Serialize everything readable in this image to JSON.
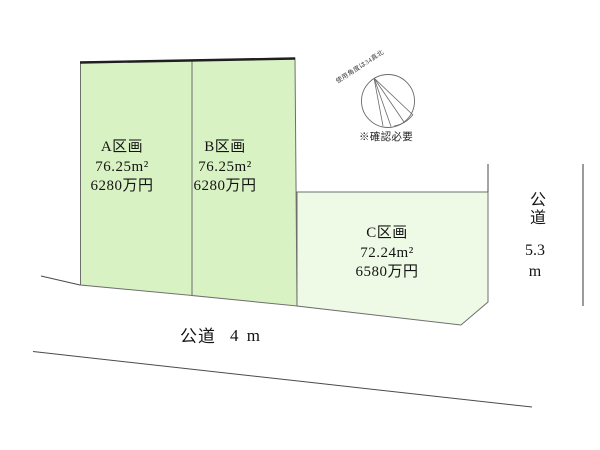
{
  "title": "土地区画図",
  "colors": {
    "plot_ab_fill": "#d8f2c4",
    "plot_c_fill": "#eefae6",
    "plot_border": "#6e6e6e",
    "road_line": "#4a4a4a",
    "top_border": "#1f1f1f"
  },
  "plots": [
    {
      "name": "A区画",
      "area": "76.25m²",
      "price": "6280万円"
    },
    {
      "name": "B区画",
      "area": "76.25m²",
      "price": "6280万円"
    },
    {
      "name": "C区画",
      "area": "72.24m²",
      "price": "6580万円"
    }
  ],
  "roads": {
    "bottom": {
      "label": "公道",
      "width": "4 m"
    },
    "right": {
      "label": "公道",
      "width_value": "5.3",
      "width_unit": "m"
    }
  },
  "compass": {
    "note": "使用角度は34真北",
    "caption": "※確認必要"
  }
}
